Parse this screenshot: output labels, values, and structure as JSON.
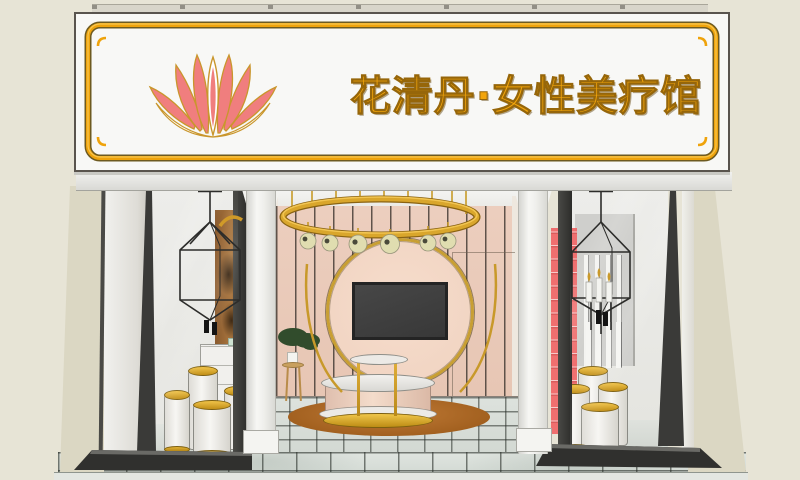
{
  "sign": {
    "text": "花清丹·女性美疗馆",
    "logo": "lotus-icon"
  },
  "scene": {
    "type": "storefront-3d-render",
    "elements": [
      "gold-framed signboard with lotus logo",
      "gold ring chandelier with globe lamps",
      "circular gold-rim feature wall with wall-mounted TV",
      "round display counter with marble top and gold base",
      "round brown rug",
      "marble tile floor",
      "left display window: wireframe pendant lamp, wood art panel, white cylinder pedestals with gold caps",
      "right display window: wireframe candle pendant, red shelf unit, white cylinder pedestals with gold caps",
      "potted bonsai plant on wooden stool"
    ]
  },
  "colors": {
    "bg": "#E7E4D6",
    "sign_face": "#F8F8F6",
    "gold": "#EFA30B",
    "gold_deep": "#8A6312",
    "text_gold": "#F2A50C",
    "text_stroke": "#96660A",
    "coral": "#F07E7E",
    "petal_outline": "#C9962C",
    "side_wall": "#DBD7C3",
    "wall_pink": "#ECCEBE",
    "circle_rim": "#C89F33",
    "ring_gold": "#D9A62C",
    "globe": "#E0DDB0",
    "tv": "#3E3E3E",
    "rug": "#B26E2E",
    "red_shelf": "#EF6F6F",
    "wood": "#A9763F",
    "frame_dark": "#30302E",
    "floor_tile": "#DCE1DC"
  }
}
